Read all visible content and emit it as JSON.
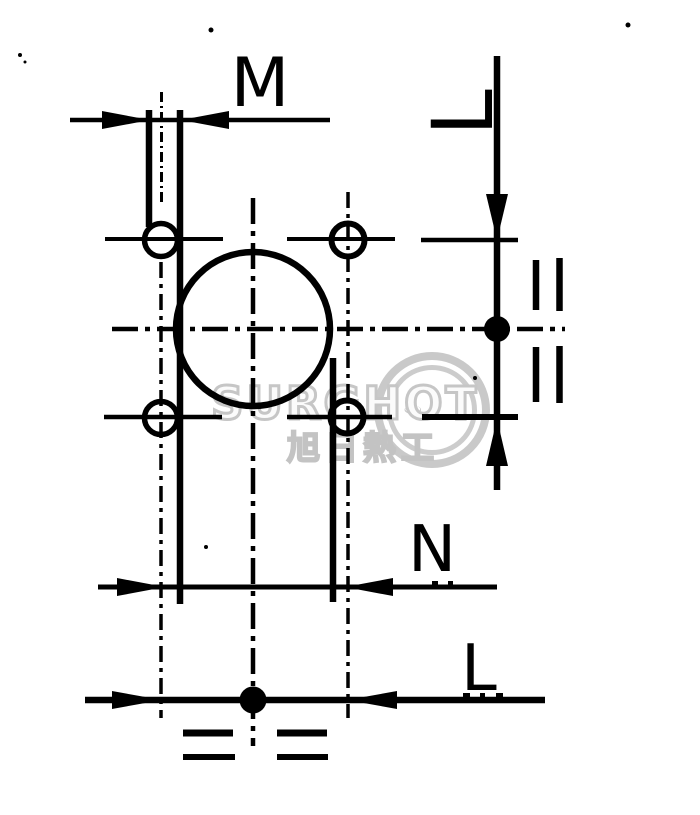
{
  "meta": {
    "type": "scanned technical dimension drawing",
    "background_color": "#ffffff",
    "ink_color": "#000000",
    "watermark_color": "#c8c8c8"
  },
  "dimension_labels": {
    "m": "M",
    "l_vertical": "L",
    "n": "N",
    "l_horizontal": "L"
  },
  "watermark": {
    "brand_text": "SURGHOT",
    "cjk_text": "旭日熱工",
    "hot_springs_icon": "♨"
  }
}
